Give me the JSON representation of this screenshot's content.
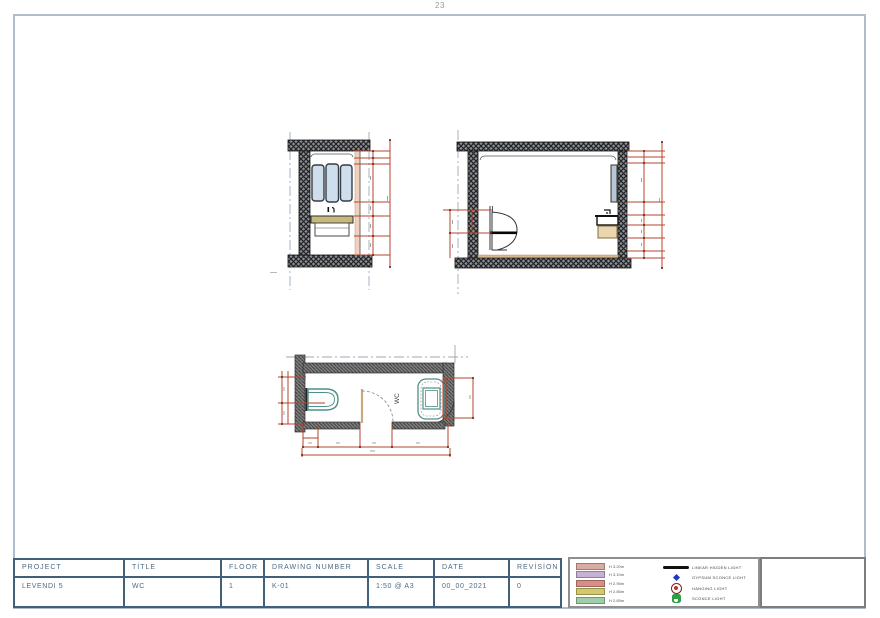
{
  "page": {
    "page_number": "23"
  },
  "plan": {
    "room_label": "WC"
  },
  "title_block": {
    "cells": [
      {
        "label": "PROJECT",
        "value": "LEVENDI 5"
      },
      {
        "label": "TİTLE",
        "value": "WC"
      },
      {
        "label": "FLOOR",
        "value": "1"
      },
      {
        "label": "DRAWİNG NUMBER",
        "value": "K-01"
      },
      {
        "label": "SCALE",
        "value": "1:50 @ A3"
      },
      {
        "label": "DATE",
        "value": "00_00_2021"
      },
      {
        "label": "REVİSİON",
        "value": "0"
      }
    ]
  },
  "legend": {
    "heights": [
      {
        "label": "H 3.20m",
        "color": "#d8aba3"
      },
      {
        "label": "H 3.10m",
        "color": "#c7b0d6"
      },
      {
        "label": "H 2.95m",
        "color": "#d88e85"
      },
      {
        "label": "H 2.85m",
        "color": "#d2ca6a"
      },
      {
        "label": "H 2.65m",
        "color": "#9fcfa9"
      }
    ],
    "lights": [
      {
        "label": "LINEAR HIDDEN LIGHT",
        "icon": "linear-hidden-light-icon"
      },
      {
        "label": "GYPSUM SCONCE LIGHT",
        "icon": "gypsum-sconce-light-icon"
      },
      {
        "label": "HANGING LIGHT",
        "icon": "hanging-light-icon"
      },
      {
        "label": "SCONCE LIGHT",
        "icon": "sconce-light-icon"
      }
    ],
    "accent_colors": {
      "dimension_red": "#b5462e",
      "fixture_teal": "#4f8f89",
      "mirror_blue": "#cfdeed",
      "counter_tan": "#c6b97c",
      "sheet_border": "#aebdcb"
    }
  }
}
